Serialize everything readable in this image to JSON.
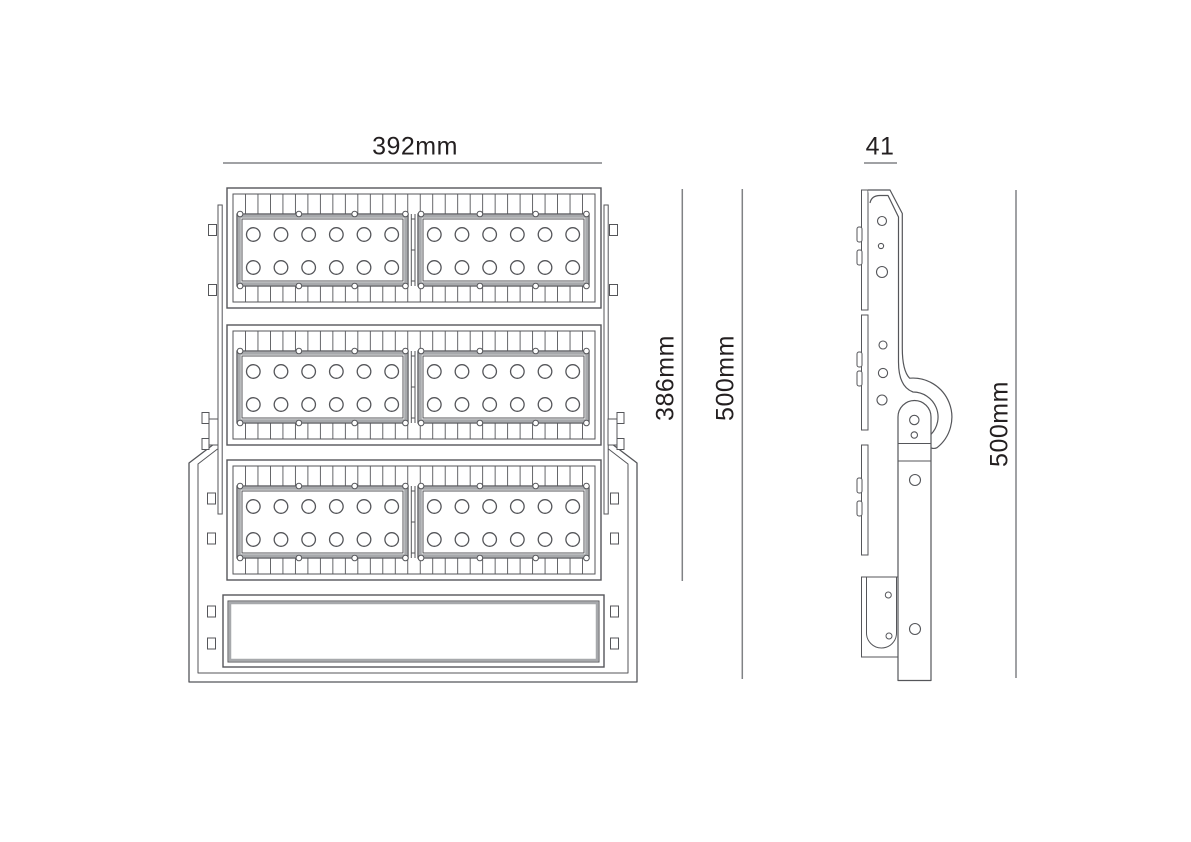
{
  "drawing": {
    "type": "technical-line-drawing",
    "subject": "LED flood light - front and side orthographic views with dimensions",
    "views": {
      "front": {
        "width_label": "392mm",
        "body_height_label": "386mm",
        "overall_height_label": "500mm",
        "module_rows": 3,
        "panels_per_row": 2,
        "led_columns": 6,
        "led_rows_per_panel": 2,
        "leds_per_panel": 12,
        "fin_cells_per_row": 29
      },
      "side": {
        "depth_label": "41",
        "overall_height_label": "500mm"
      }
    },
    "colors": {
      "background": "#ffffff",
      "line": "#55565a",
      "dim_line": "#808285",
      "panel_frame": "#a7a9ac",
      "text": "#231f20"
    }
  }
}
